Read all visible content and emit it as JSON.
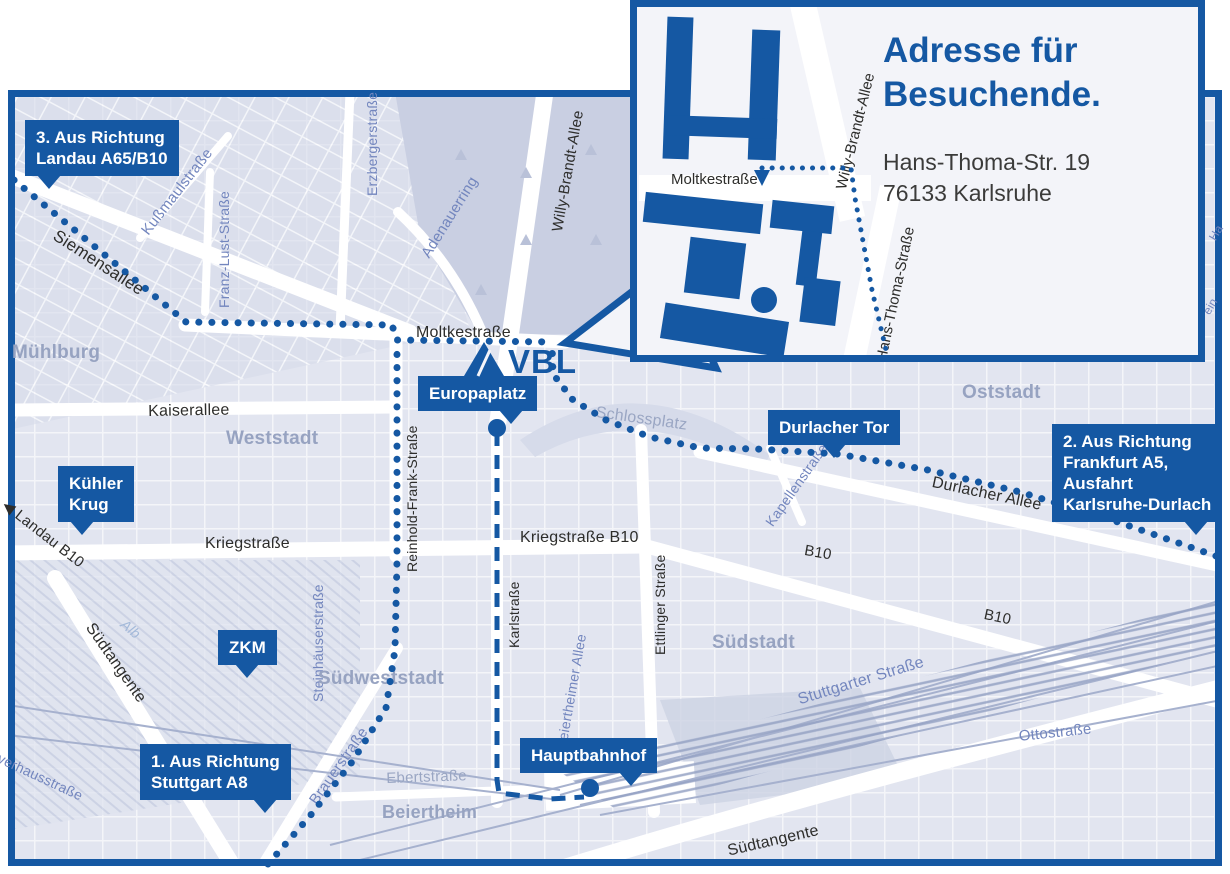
{
  "colors": {
    "brand": "#1558A3",
    "map_bg": "#E9EBF3",
    "blocks": "#DADFEC",
    "park": "#C9CFE2",
    "road": "#FFFFFF",
    "rail": "#A6B1CE",
    "major_label": "#2D2D2B",
    "minor_label": "#7386BE",
    "district_label": "#97A3C1",
    "address_text": "#3B3B3A"
  },
  "inset": {
    "title1": "Adresse für",
    "title2": "Besuchende.",
    "addr1": "Hans-Thoma-Str. 19",
    "addr2": "76133 Karlsruhe",
    "moltke": "Moltkestraße",
    "wba": "Willy-Brandt-Allee",
    "hts": "Hans-Thoma-Straße"
  },
  "map": {
    "vbl": "VBL",
    "badges": [
      {
        "name": "badge-from-landau",
        "lines": [
          "3. Aus Richtung",
          "Landau A65/B10"
        ],
        "x": 25,
        "y": 120,
        "tail": "bl"
      },
      {
        "name": "badge-kuehler-krug",
        "lines": [
          "Kühler",
          "Krug"
        ],
        "x": 58,
        "y": 466,
        "tail": "bl"
      },
      {
        "name": "badge-zkm",
        "lines": [
          "ZKM"
        ],
        "x": 218,
        "y": 630,
        "tail": "bm"
      },
      {
        "name": "badge-europaplatz",
        "lines": [
          "Europaplatz"
        ],
        "x": 418,
        "y": 376,
        "tail": "br"
      },
      {
        "name": "badge-durlacher-tor",
        "lines": [
          "Durlacher Tor"
        ],
        "x": 768,
        "y": 410,
        "tail": "bm"
      },
      {
        "name": "badge-from-frankfurt",
        "lines": [
          "2. Aus Richtung",
          "Frankfurt A5,",
          "Ausfahrt",
          "Karlsruhe-Durlach"
        ],
        "x": 1052,
        "y": 424,
        "tail": "br"
      },
      {
        "name": "badge-hauptbahnhof",
        "lines": [
          "Hauptbahnhof"
        ],
        "x": 520,
        "y": 738,
        "tail": "br"
      },
      {
        "name": "badge-from-stuttgart",
        "lines": [
          "1. Aus Richtung",
          "Stuttgart A8"
        ],
        "x": 140,
        "y": 744,
        "tail": "br"
      }
    ],
    "labels": [
      {
        "t": "Siemensallee",
        "x": 60,
        "y": 226,
        "r": 33,
        "c": "major",
        "s": 17
      },
      {
        "t": "Kußmaulstraße",
        "x": 138,
        "y": 228,
        "r": -52,
        "c": "minor",
        "s": 15
      },
      {
        "t": "Franz-Lust-Straße",
        "x": 216,
        "y": 308,
        "r": -90,
        "c": "minor",
        "s": 14
      },
      {
        "t": "Erzbergerstraße",
        "x": 364,
        "y": 196,
        "r": -90,
        "c": "minor",
        "s": 14
      },
      {
        "t": "Willy-Brandt-Allee",
        "x": 549,
        "y": 230,
        "r": -80,
        "c": "major",
        "s": 15
      },
      {
        "t": "Adenauerring",
        "x": 418,
        "y": 252,
        "r": -58,
        "c": "minor",
        "s": 15
      },
      {
        "t": "Moltkestraße",
        "x": 416,
        "y": 324,
        "r": 0,
        "c": "major",
        "s": 16
      },
      {
        "t": "Kaiserallee",
        "x": 148,
        "y": 403,
        "r": -1,
        "c": "major",
        "s": 16
      },
      {
        "t": "Mühlburg",
        "x": 12,
        "y": 342,
        "r": 0,
        "c": "district",
        "s": 19
      },
      {
        "t": "Weststadt",
        "x": 226,
        "y": 428,
        "r": 0,
        "c": "district",
        "s": 19
      },
      {
        "t": "Oststadt",
        "x": 962,
        "y": 382,
        "r": 0,
        "c": "district",
        "s": 19
      },
      {
        "t": "Schlossplatz",
        "x": 597,
        "y": 404,
        "r": 8,
        "c": "dim",
        "s": 16
      },
      {
        "t": "Durlacher Allee",
        "x": 934,
        "y": 474,
        "r": 12,
        "c": "major",
        "s": 16
      },
      {
        "t": "Kapellenstraße",
        "x": 762,
        "y": 520,
        "r": -55,
        "c": "minor",
        "s": 14
      },
      {
        "t": "B10",
        "x": 806,
        "y": 542,
        "r": 10,
        "c": "major",
        "s": 15
      },
      {
        "t": "B10",
        "x": 986,
        "y": 606,
        "r": 12,
        "c": "major",
        "s": 15
      },
      {
        "t": "Kriegstraße",
        "x": 205,
        "y": 535,
        "r": 0,
        "c": "major",
        "s": 16
      },
      {
        "t": "Kriegstraße B10",
        "x": 520,
        "y": 529,
        "r": 0,
        "c": "major",
        "s": 16
      },
      {
        "t": "Reinhold-Frank-Straße",
        "x": 404,
        "y": 572,
        "r": -90,
        "c": "major",
        "s": 14
      },
      {
        "t": "Karlstraße",
        "x": 506,
        "y": 648,
        "r": -90,
        "c": "major",
        "s": 14
      },
      {
        "t": "Ettlinger Straße",
        "x": 652,
        "y": 655,
        "r": -90,
        "c": "major",
        "s": 14
      },
      {
        "t": "Beiertheimer Allee",
        "x": 553,
        "y": 748,
        "r": -80,
        "c": "minor",
        "s": 14
      },
      {
        "t": "Südstadt",
        "x": 712,
        "y": 632,
        "r": 0,
        "c": "district",
        "s": 19
      },
      {
        "t": "Stuttgarter Straße",
        "x": 796,
        "y": 692,
        "r": -17,
        "c": "minor",
        "s": 16
      },
      {
        "t": "Steinhäuserstraße",
        "x": 310,
        "y": 702,
        "r": -90,
        "c": "minor",
        "s": 14
      },
      {
        "t": "Südweststadt",
        "x": 318,
        "y": 668,
        "r": 0,
        "c": "district",
        "s": 19
      },
      {
        "t": "Alb",
        "x": 128,
        "y": 616,
        "r": 40,
        "c": "water",
        "s": 14
      },
      {
        "t": "Südtangente",
        "x": 96,
        "y": 620,
        "r": 55,
        "c": "major",
        "s": 16
      },
      {
        "t": "Südtangente",
        "x": 726,
        "y": 843,
        "r": -13,
        "c": "major",
        "s": 16
      },
      {
        "t": "◀ Landau B10",
        "x": 10,
        "y": 496,
        "r": 38,
        "c": "major",
        "s": 15
      },
      {
        "t": "Ebertstraße",
        "x": 386,
        "y": 770,
        "r": -2,
        "c": "dim",
        "s": 15
      },
      {
        "t": "Beiertheim",
        "x": 382,
        "y": 802,
        "r": 0,
        "c": "district",
        "s": 18
      },
      {
        "t": "Brauerstraße",
        "x": 306,
        "y": 798,
        "r": -55,
        "c": "minor",
        "s": 15
      },
      {
        "t": "Ottostraße",
        "x": 1018,
        "y": 728,
        "r": -6,
        "c": "minor",
        "s": 15
      },
      {
        "t": "Ostring",
        "x": 1148,
        "y": 422,
        "r": 55,
        "c": "minor",
        "s": 15
      },
      {
        "t": "verhausstraße",
        "x": 2,
        "y": 750,
        "r": 25,
        "c": "minor",
        "s": 14
      },
      {
        "t": "Ha",
        "x": 1206,
        "y": 236,
        "r": -60,
        "c": "minor",
        "s": 12
      },
      {
        "t": "ein",
        "x": 1200,
        "y": 310,
        "r": -60,
        "c": "minor",
        "s": 12
      }
    ],
    "routes": [
      {
        "name": "route-from-landau",
        "style": "dots",
        "pts": [
          [
            14,
            180
          ],
          [
            186,
            322
          ],
          [
            392,
            325
          ],
          [
            397,
            340
          ],
          [
            552,
            342
          ]
        ]
      },
      {
        "name": "route-from-stuttgart",
        "style": "dots",
        "pts": [
          [
            268,
            864
          ],
          [
            310,
            816
          ],
          [
            352,
            762
          ],
          [
            386,
            708
          ],
          [
            395,
            650
          ],
          [
            397,
            560
          ],
          [
            397,
            342
          ]
        ]
      },
      {
        "name": "route-from-frankfurt",
        "style": "dots",
        "pts": [
          [
            1216,
            556
          ],
          [
            1118,
            522
          ],
          [
            1020,
            492
          ],
          [
            928,
            470
          ],
          [
            838,
            454
          ],
          [
            757,
            449
          ],
          [
            700,
            448
          ],
          [
            650,
            437
          ],
          [
            606,
            420
          ],
          [
            573,
            400
          ],
          [
            553,
            374
          ],
          [
            552,
            344
          ]
        ]
      },
      {
        "name": "route-to-hauptbahnhof",
        "style": "dash",
        "pts": [
          [
            497,
            432
          ],
          [
            497,
            780
          ],
          [
            499,
            793
          ],
          [
            550,
            799
          ],
          [
            584,
            797
          ]
        ]
      },
      {
        "name": "inset-route",
        "style": "dots-small",
        "pts": [
          [
            762,
            168
          ],
          [
            851,
            168
          ],
          [
            855,
            198
          ],
          [
            872,
            290
          ],
          [
            886,
            350
          ]
        ]
      }
    ],
    "stops": [
      {
        "name": "europaplatz-stop",
        "x": 497,
        "y": 428
      },
      {
        "name": "hauptbahnhof-stop",
        "x": 590,
        "y": 788
      }
    ]
  }
}
